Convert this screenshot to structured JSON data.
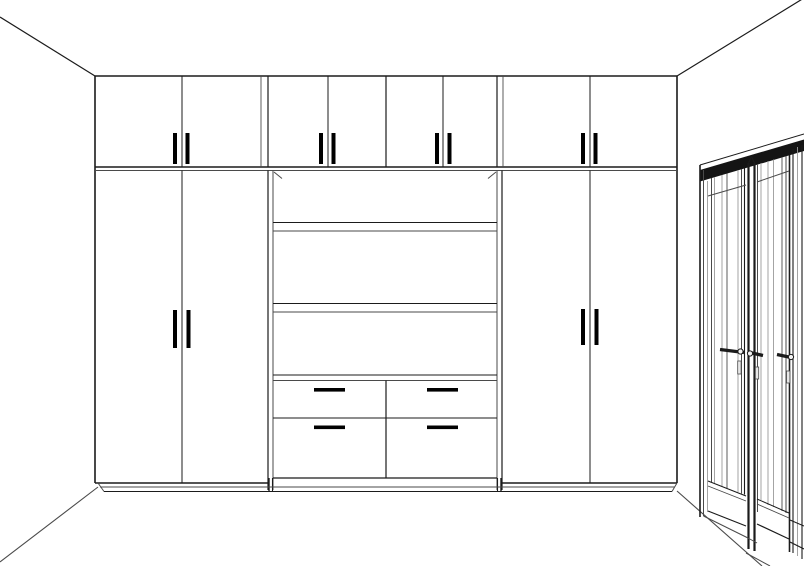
{
  "meta": {
    "view": "3d-room-elevation-line-render",
    "subject": "built-in wardrobe wall with entry doors",
    "visible_text": "none"
  },
  "colors": {
    "background": "#ffffff",
    "line": "#1b1b1b",
    "line_soft": "#4a4a4a",
    "line_light": "#9a9a9a",
    "handle": "#000000",
    "door_head_band": "#141414"
  },
  "room": {
    "ceiling_edges": 2,
    "floor_edges": 2,
    "walls_visible": 3
  },
  "wardrobe": {
    "upper_row": {
      "cabinets": 4,
      "doors": 8,
      "handle_pairs": 4
    },
    "left_tall_cabinet": {
      "doors": 2,
      "handles": 2
    },
    "right_tall_cabinet": {
      "doors": 2,
      "handles": 2
    },
    "center_niche": {
      "open_shelves": 3,
      "corner_depth_ticks": 2
    },
    "drawer_unit": {
      "rows": 2,
      "columns": 2,
      "drawers": 4,
      "handles": 4
    },
    "plinth": true
  },
  "entry_door": {
    "type": "double-entry-doors-in-perspective",
    "leaves_visible": 3,
    "astragal": true,
    "lever_handles": 3,
    "key_plates": 3
  }
}
